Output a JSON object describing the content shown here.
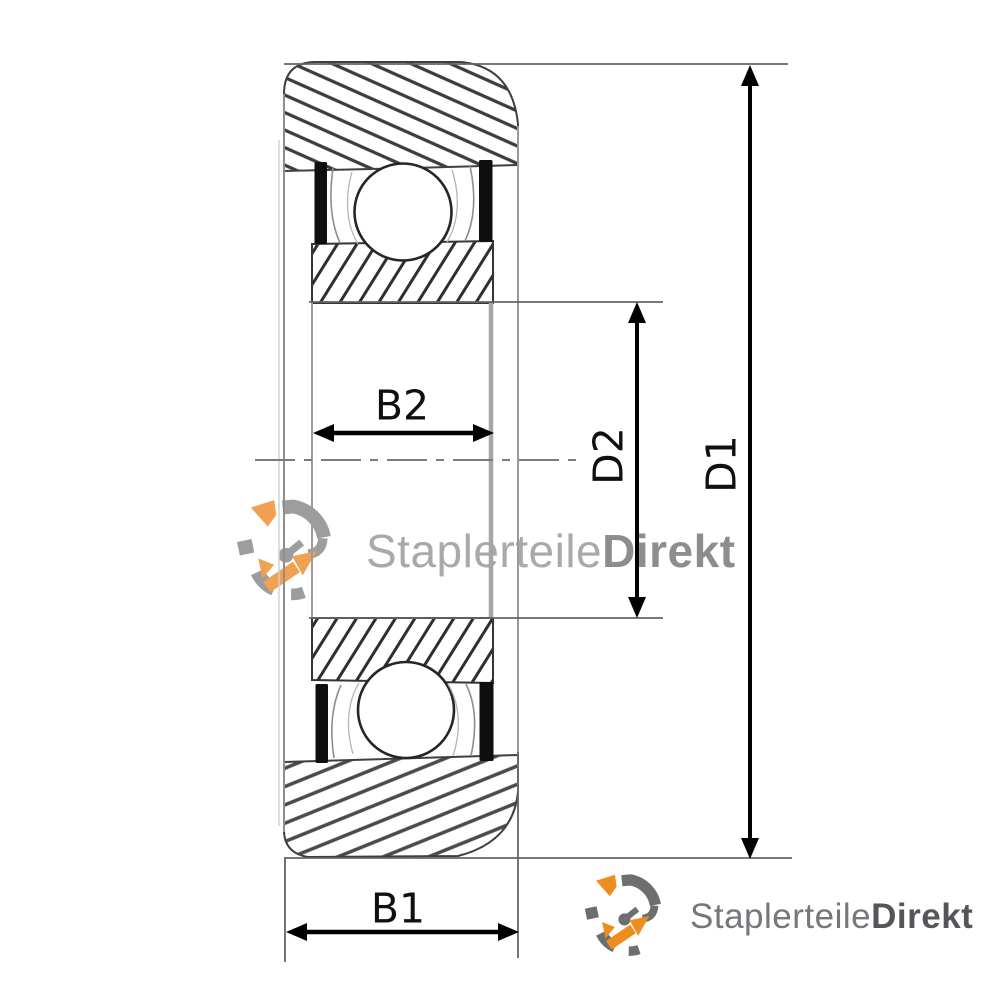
{
  "drawing": {
    "type": "bearing-cross-section",
    "dimensions": {
      "b1": "B1",
      "b2": "B2",
      "d1": "D1",
      "d2": "D2"
    }
  },
  "brand": {
    "name_regular": "Staplerteile",
    "name_bold": "Direkt",
    "icon": "gear-arrows-icon",
    "colors": {
      "orange": "#EE8D1F",
      "gray": "#6D6E70",
      "watermark_gray": "#A9A9A9",
      "text_dark": "#55565A"
    }
  }
}
